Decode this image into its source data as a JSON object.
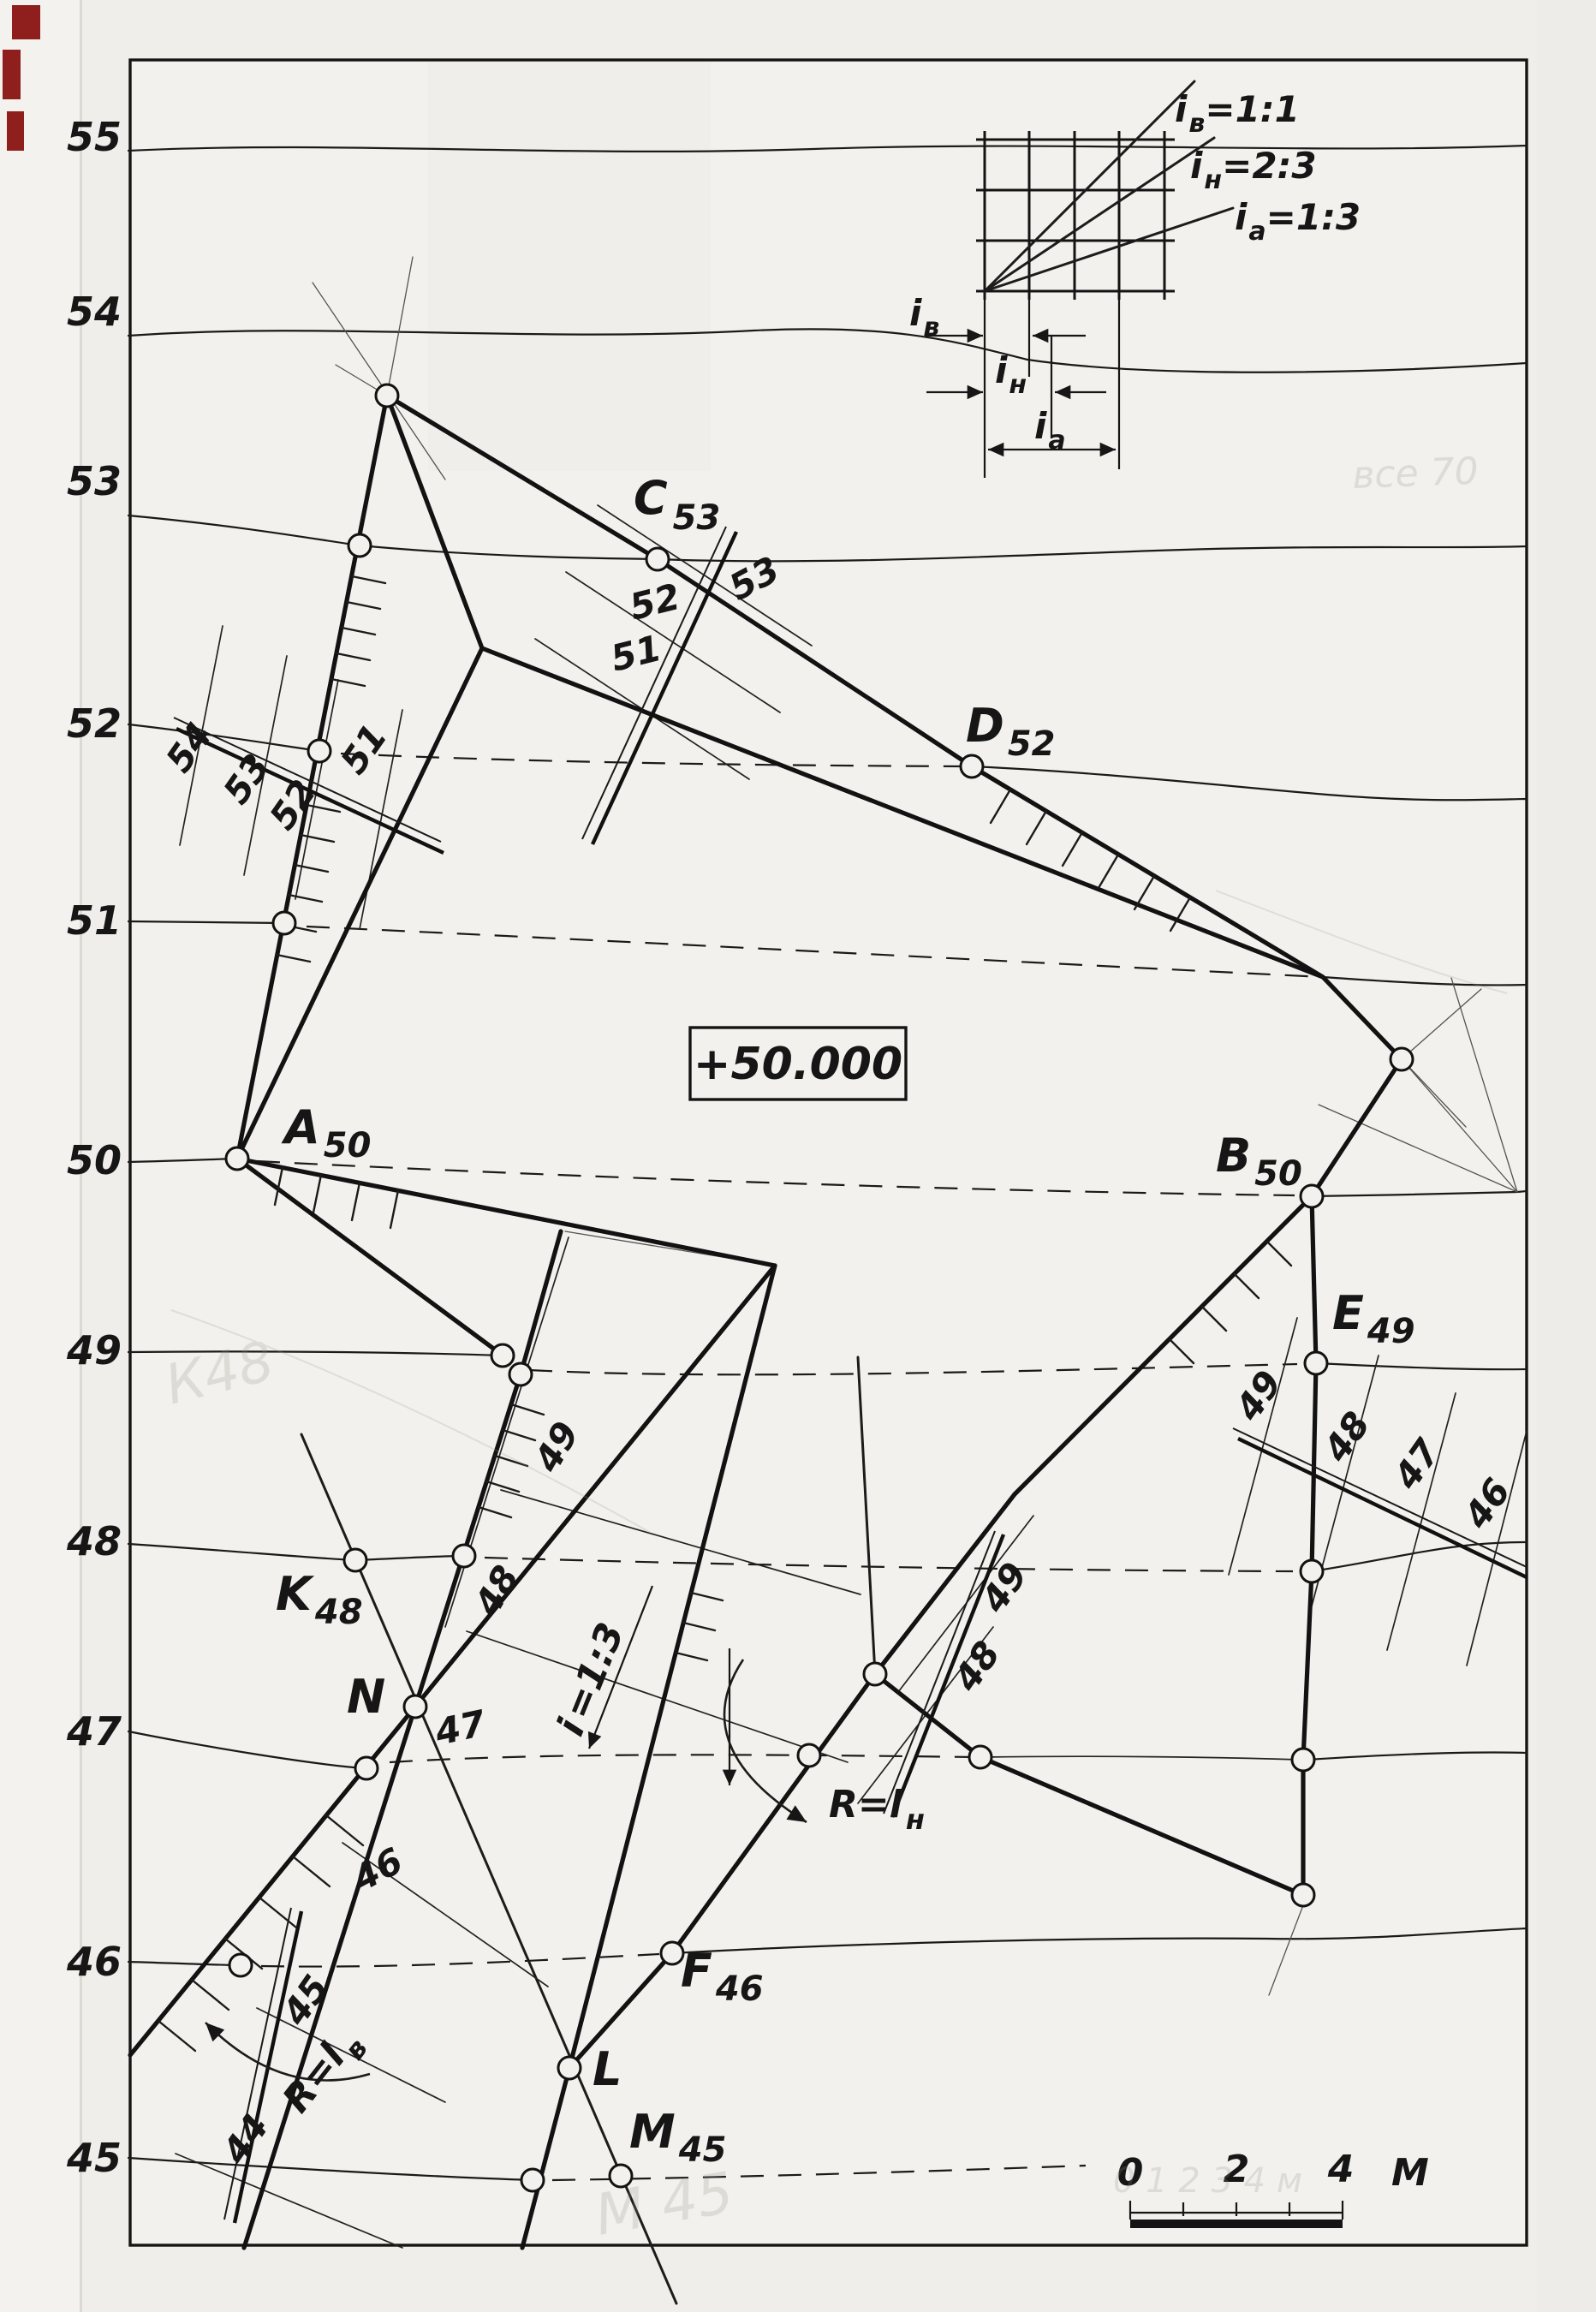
{
  "axis": [
    "55",
    "54",
    "53",
    "52",
    "51",
    "50",
    "49",
    "48",
    "47",
    "46",
    "45"
  ],
  "pts": {
    "A": "A",
    "A_s": "50",
    "B": "B",
    "B_s": "50",
    "C": "C",
    "C_s": "53",
    "D": "D",
    "D_s": "52",
    "E": "E",
    "E_s": "49",
    "K": "K",
    "K_s": "48",
    "N": "N",
    "F": "F",
    "F_s": "46",
    "L": "L",
    "M": "M",
    "M_s": "45"
  },
  "platform_mark": "+50.000",
  "slope_scales": {
    "left": [
      "54",
      "53",
      "52",
      "51"
    ],
    "c": [
      "53",
      "52",
      "51"
    ],
    "ml": [
      "49",
      "48"
    ],
    "mid": [
      "49",
      "48"
    ],
    "right": [
      "49",
      "48",
      "47",
      "46"
    ],
    "bl": [
      "45",
      "44"
    ],
    "n": [
      "47",
      "46"
    ]
  },
  "annotations": {
    "i13a": "i",
    "i13b": "=1:3",
    "rn_a": "R=l",
    "rn_b": "н",
    "rv_a": "R=l",
    "rv_b": "в"
  },
  "inset": {
    "r1a": "i",
    "r1b": "в",
    "r1c": "=1:1",
    "r2a": "i",
    "r2b": "н",
    "r2c": "=2:3",
    "r3a": "i",
    "r3b": "а",
    "r3c": "=1:3",
    "d1a": "i",
    "d1b": "в",
    "d2a": "i",
    "d2b": "н",
    "d3a": "i",
    "d3b": "а"
  },
  "scale_bar": {
    "t0": "0",
    "t2": "2",
    "t4": "4",
    "unit": "М"
  },
  "ghosts": {
    "g1": "все 70",
    "g2": "К48",
    "g3": "0 1 2 3 4 м",
    "g4": "М 45"
  }
}
